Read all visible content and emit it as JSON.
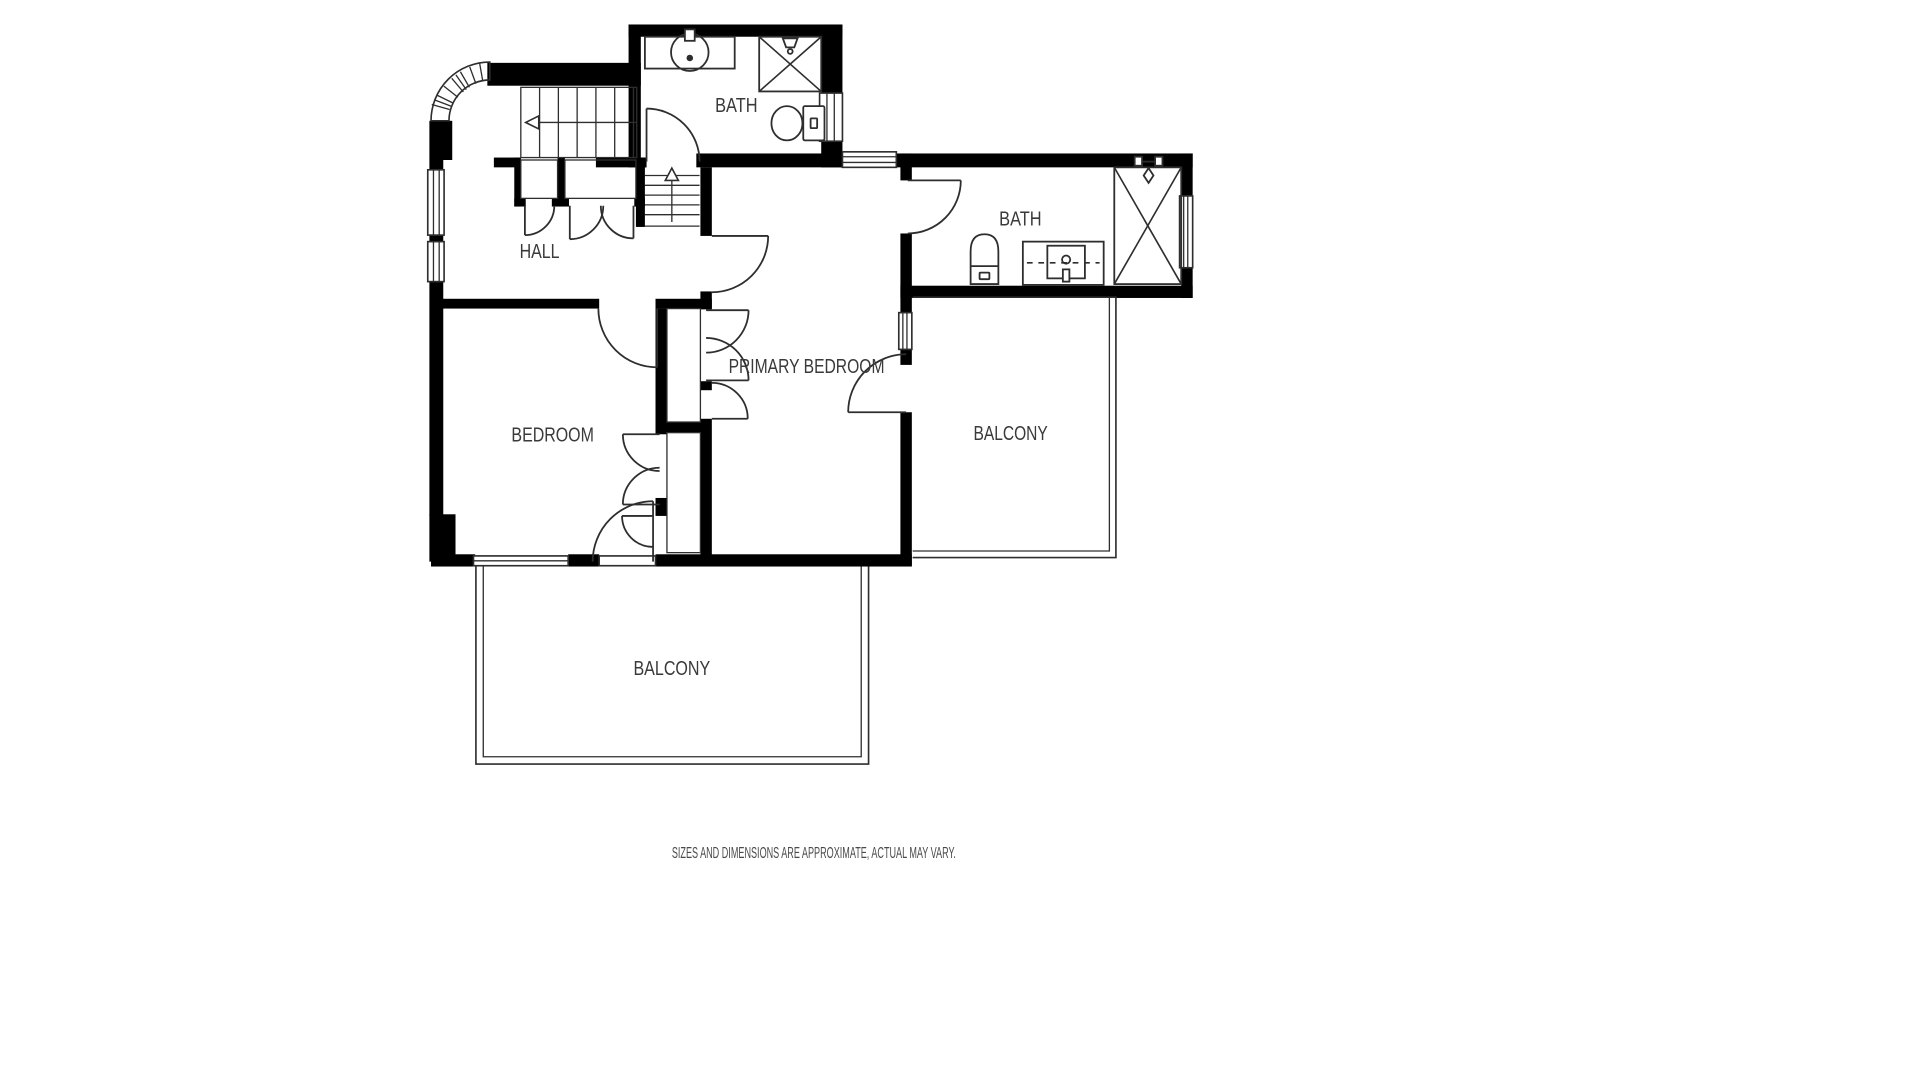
{
  "floor_plan": {
    "rooms": [
      {
        "name": "bath-top",
        "label": "BATH"
      },
      {
        "name": "bath-ensuite",
        "label": "BATH"
      },
      {
        "name": "hall",
        "label": "HALL"
      },
      {
        "name": "primary-bedroom",
        "label": "PRIMARY BEDROOM"
      },
      {
        "name": "bedroom",
        "label": "BEDROOM"
      },
      {
        "name": "balcony-side",
        "label": "BALCONY"
      },
      {
        "name": "balcony-bottom",
        "label": "BALCONY"
      }
    ],
    "disclaimer": "SIZES AND DIMENSIONS ARE APPROXIMATE, ACTUAL MAY VARY.",
    "colors": {
      "wall": "#000000",
      "line": "#2e2e2e",
      "label": "#3a3a3a",
      "disclaimer": "#4a4a4a",
      "background": "#ffffff"
    }
  }
}
